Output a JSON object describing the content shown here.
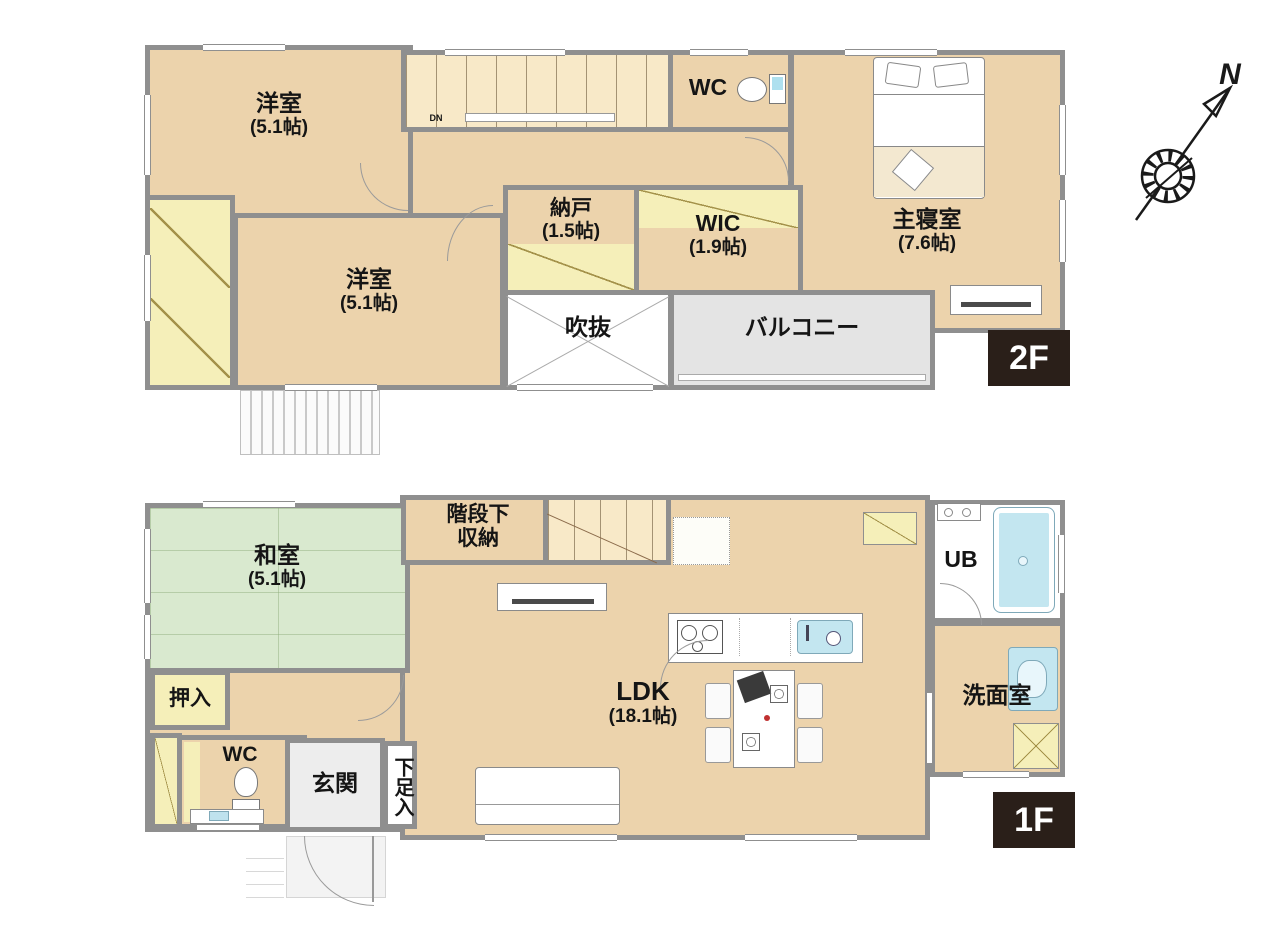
{
  "compass": {
    "label": "N"
  },
  "colors": {
    "floor_tan": "#ecd3ac",
    "tatami_green": "#d9e9cf",
    "closet_yellow": "#f5efb9",
    "balcony_gray": "#e4e4e4",
    "stairs_cream": "#f8e9c8",
    "water_blue": "#c3e6f0",
    "wall_gray": "#8f8f8f",
    "badge_bg": "#2a1f19",
    "badge_fg": "#ffffff"
  },
  "floor2": {
    "badge": "2F",
    "stairs": {
      "dn_label": "DN"
    },
    "rooms": {
      "yoshitsu1": {
        "label": "洋室",
        "size": "(5.1帖)"
      },
      "yoshitsu2": {
        "label": "洋室",
        "size": "(5.1帖)"
      },
      "nando": {
        "label": "納戸",
        "size": "(1.5帖)"
      },
      "wic": {
        "label": "WIC",
        "size": "(1.9帖)"
      },
      "wc": {
        "label": "WC"
      },
      "master": {
        "label": "主寝室",
        "size": "(7.6帖)"
      },
      "fukinuke": {
        "label": "吹抜"
      },
      "balcony": {
        "label": "バルコニー"
      }
    }
  },
  "floor1": {
    "badge": "1F",
    "rooms": {
      "washitsu": {
        "label": "和室",
        "size": "(5.1帖)"
      },
      "oshiire": {
        "label": "押入"
      },
      "wc": {
        "label": "WC"
      },
      "genkan": {
        "label": "玄関"
      },
      "getabako": {
        "label": "下足入"
      },
      "kaidanshita": {
        "label": "階段下",
        "label2": "収納"
      },
      "ldk": {
        "label": "LDK",
        "size": "(18.1帖)"
      },
      "ub": {
        "label": "UB"
      },
      "senmen": {
        "label": "洗面室"
      }
    }
  }
}
